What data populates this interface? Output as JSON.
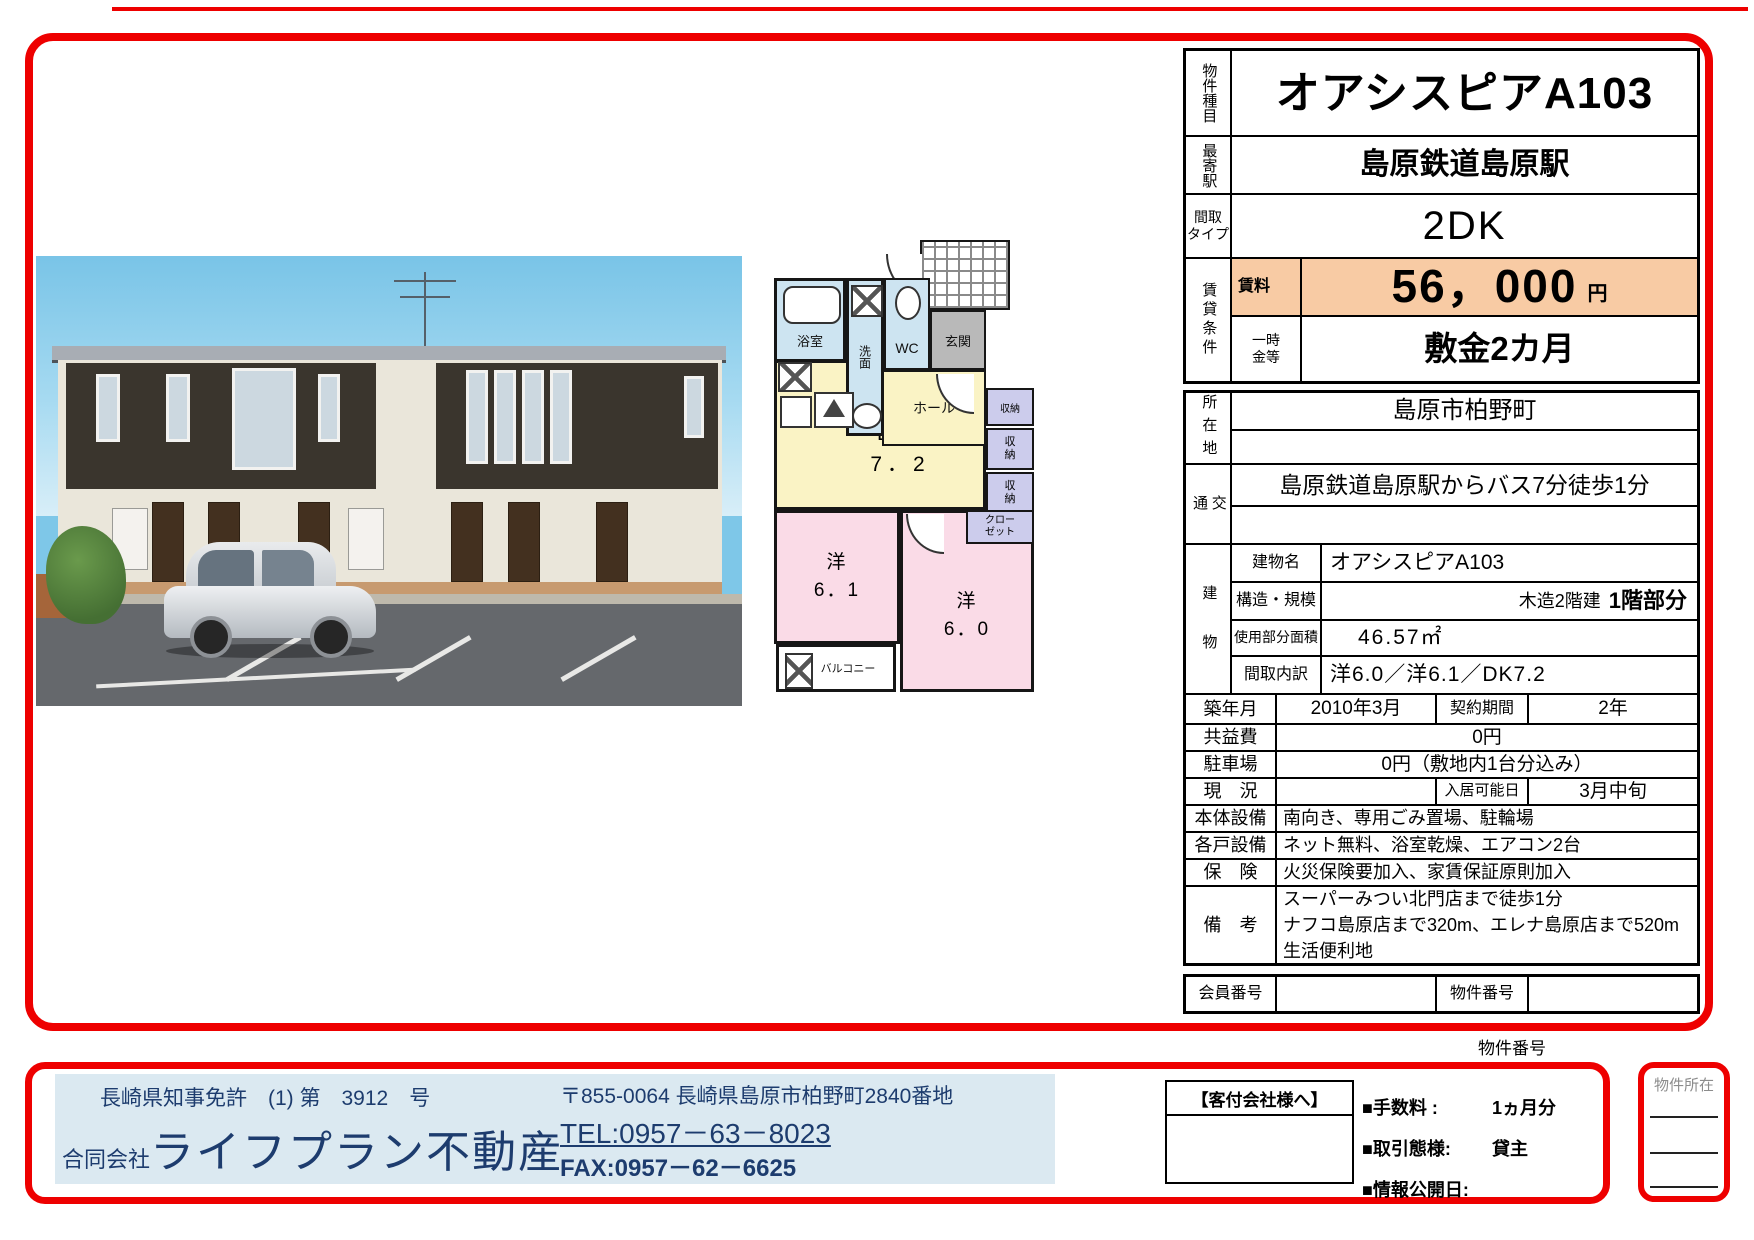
{
  "misc": {
    "property_number_caption": "物件番号"
  },
  "colors": {
    "frame_red": "#ee0000",
    "rent_highlight": "#f8cba4",
    "footer_blue": "#dbe9f1",
    "footer_text_navy": "#1d3c6e"
  },
  "table": {
    "property_type_label": "物件種目",
    "property_name": "オアシスピアA103",
    "station_label": "最寄駅",
    "station": "島原鉄道島原駅",
    "madori_label": "間取\nタイプ",
    "madori": "2DK",
    "chintai_label": "賃貸条件",
    "rent_label": "賃料",
    "rent_value": "56，000",
    "rent_unit": "円",
    "ichijikin_label": "一時\n金等",
    "ichijikin": "敷金2カ月",
    "location_label": "所在地",
    "location": "島原市柏野町",
    "access_label": "交通",
    "access": "島原鉄道島原駅からバス7分徒歩1分",
    "building_label": "建物",
    "building_name_label": "建物名",
    "building_name": "オアシスピアA103",
    "structure_label": "構造・規模",
    "structure_a": "木造2階建",
    "structure_b": "1階部分",
    "area_label": "使用部分面積",
    "area": "46.57㎡",
    "madori_detail_label": "間取内訳",
    "madori_detail": "洋6.0／洋6.1／DK7.2",
    "built_label": "築年月",
    "built": "2010年3月",
    "contract_label": "契約期間",
    "contract": "2年",
    "kyoekihi_label": "共益費",
    "kyoekihi": "0円",
    "parking_label": "駐車場",
    "parking": "0円（敷地内1台分込み）",
    "status_label": "現　況",
    "status": "",
    "movein_label": "入居可能日",
    "movein": "3月中旬",
    "main_equipment_label": "本体設備",
    "main_equipment": "南向き、専用ごみ置場、駐輪場",
    "unit_equipment_label": "各戸設備",
    "unit_equipment": "ネット無料、浴室乾燥、エアコン2台",
    "insurance_label": "保　険",
    "insurance": "火災保険要加入、家賃保証原則加入",
    "remarks_label": "備　考",
    "remarks": "スーパーみつい北門店まで徒歩1分\nナフコ島原店まで320m、エレナ島原店まで520m\n生活便利地",
    "member_label": "会員番号",
    "member": "",
    "property_no_label": "物件番号",
    "property_no": ""
  },
  "floorplan": {
    "bath": "浴室",
    "wash": "洗面",
    "wc": "WC",
    "genkan": "玄関",
    "hall": "ホール",
    "dk": "ＤＫ\n7．2",
    "shuno_h": "収納",
    "shuno_v": "収\n納",
    "closet": "クロー\nゼット",
    "yo61": "洋\n6．1",
    "yo60": "洋\n6．0",
    "balcony": "バルコニー"
  },
  "footer": {
    "license": "長崎県知事免許　(1) 第　3912　号",
    "company_prefix": "合同会社",
    "company_name": "ライフプラン不動産",
    "postal_address": "〒855-0064  長崎県島原市柏野町2840番地",
    "tel": "TEL:0957－63－8023",
    "fax": "FAX:0957－62－6625",
    "kyakutsuke_title": "【客付会社様へ】",
    "fee_label": "■手数料 :",
    "fee_value": "1ヵ月分",
    "torihiki_label": "■取引態様:",
    "torihiki_value": "貸主",
    "info_label": "■情報公開日:",
    "info_value": "",
    "bukken_shozai": "物件所在"
  }
}
